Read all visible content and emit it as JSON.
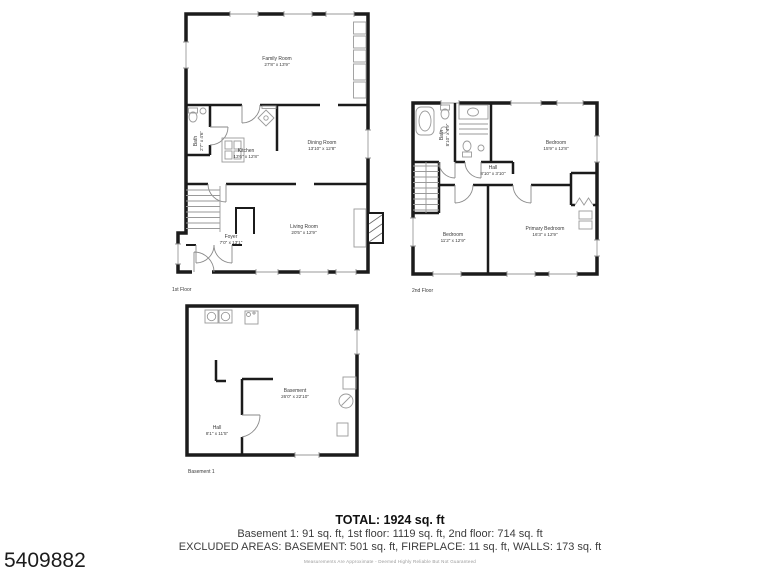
{
  "listing_id": "5409882",
  "floors": {
    "first": {
      "caption": "1st Floor",
      "rooms": {
        "family": {
          "name": "Family Room",
          "dims": "27'8\" x 13'9\""
        },
        "dining": {
          "name": "Dining Room",
          "dims": "13'10\" x 12'8\""
        },
        "kitchen": {
          "name": "Kitchen",
          "dims": "13'6\" x 12'8\""
        },
        "bath": {
          "name": "Bath",
          "dims": "2'7\" x 4'6\""
        },
        "living": {
          "name": "Living Room",
          "dims": "20'5\" x 12'9\""
        },
        "foyer": {
          "name": "Foyer",
          "dims": "7'0\" x 13'1\""
        }
      }
    },
    "second": {
      "caption": "2nd Floor",
      "rooms": {
        "bath": {
          "name": "Bath",
          "dims": "8'10\" x 4'9\""
        },
        "bedroom_top": {
          "name": "Bedroom",
          "dims": "15'9\" x 12'8\""
        },
        "hall": {
          "name": "Hall",
          "dims": "8'10\" x 3'10\""
        },
        "bedroom_left": {
          "name": "Bedroom",
          "dims": "11'2\" x 12'9\""
        },
        "primary": {
          "name": "Primary Bedroom",
          "dims": "16'3\" x 12'9\""
        }
      }
    },
    "basement": {
      "caption": "Basement 1",
      "rooms": {
        "basement": {
          "name": "Basement",
          "dims": "26'0\" x 22'10\""
        },
        "hall": {
          "name": "Hall",
          "dims": "8'1\" x 11'5\""
        }
      }
    }
  },
  "summary": {
    "total": "TOTAL: 1924 sq. ft",
    "line1": "Basement 1: 91 sq. ft, 1st floor: 1119 sq. ft, 2nd floor: 714 sq. ft",
    "line2": "EXCLUDED AREAS: BASEMENT: 501 sq. ft, FIREPLACE: 11 sq. ft, WALLS: 173 sq. ft",
    "disclaimer": "Measurements Are Approximate - Deemed Highly Reliable But Not Guaranteed"
  }
}
